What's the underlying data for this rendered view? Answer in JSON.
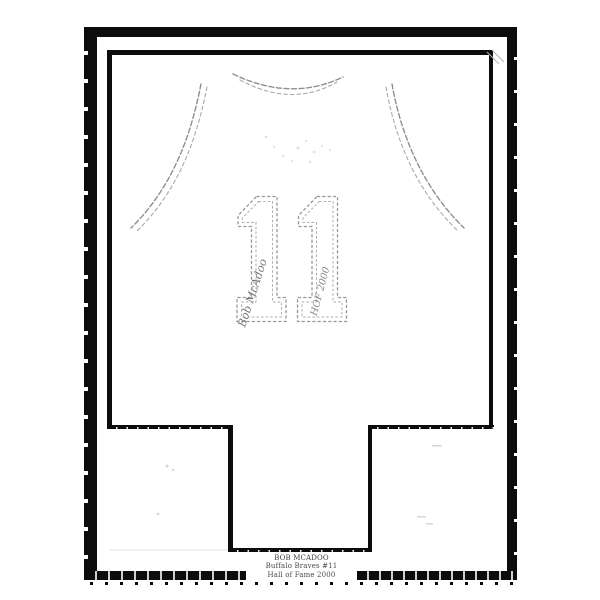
{
  "colors": {
    "background": "#ffffff",
    "frame": "#0c0c0c",
    "sketch": "#8f8f8f",
    "nameplate_text": "#4a4a4a"
  },
  "jersey": {
    "number": "11",
    "autograph": "Bob McAdoo",
    "inscription": "HOF 2000"
  },
  "nameplate": {
    "line1": "BOB MCADOO",
    "line2": "Buffalo Braves #11",
    "line3": "Hall of Fame 2000"
  }
}
